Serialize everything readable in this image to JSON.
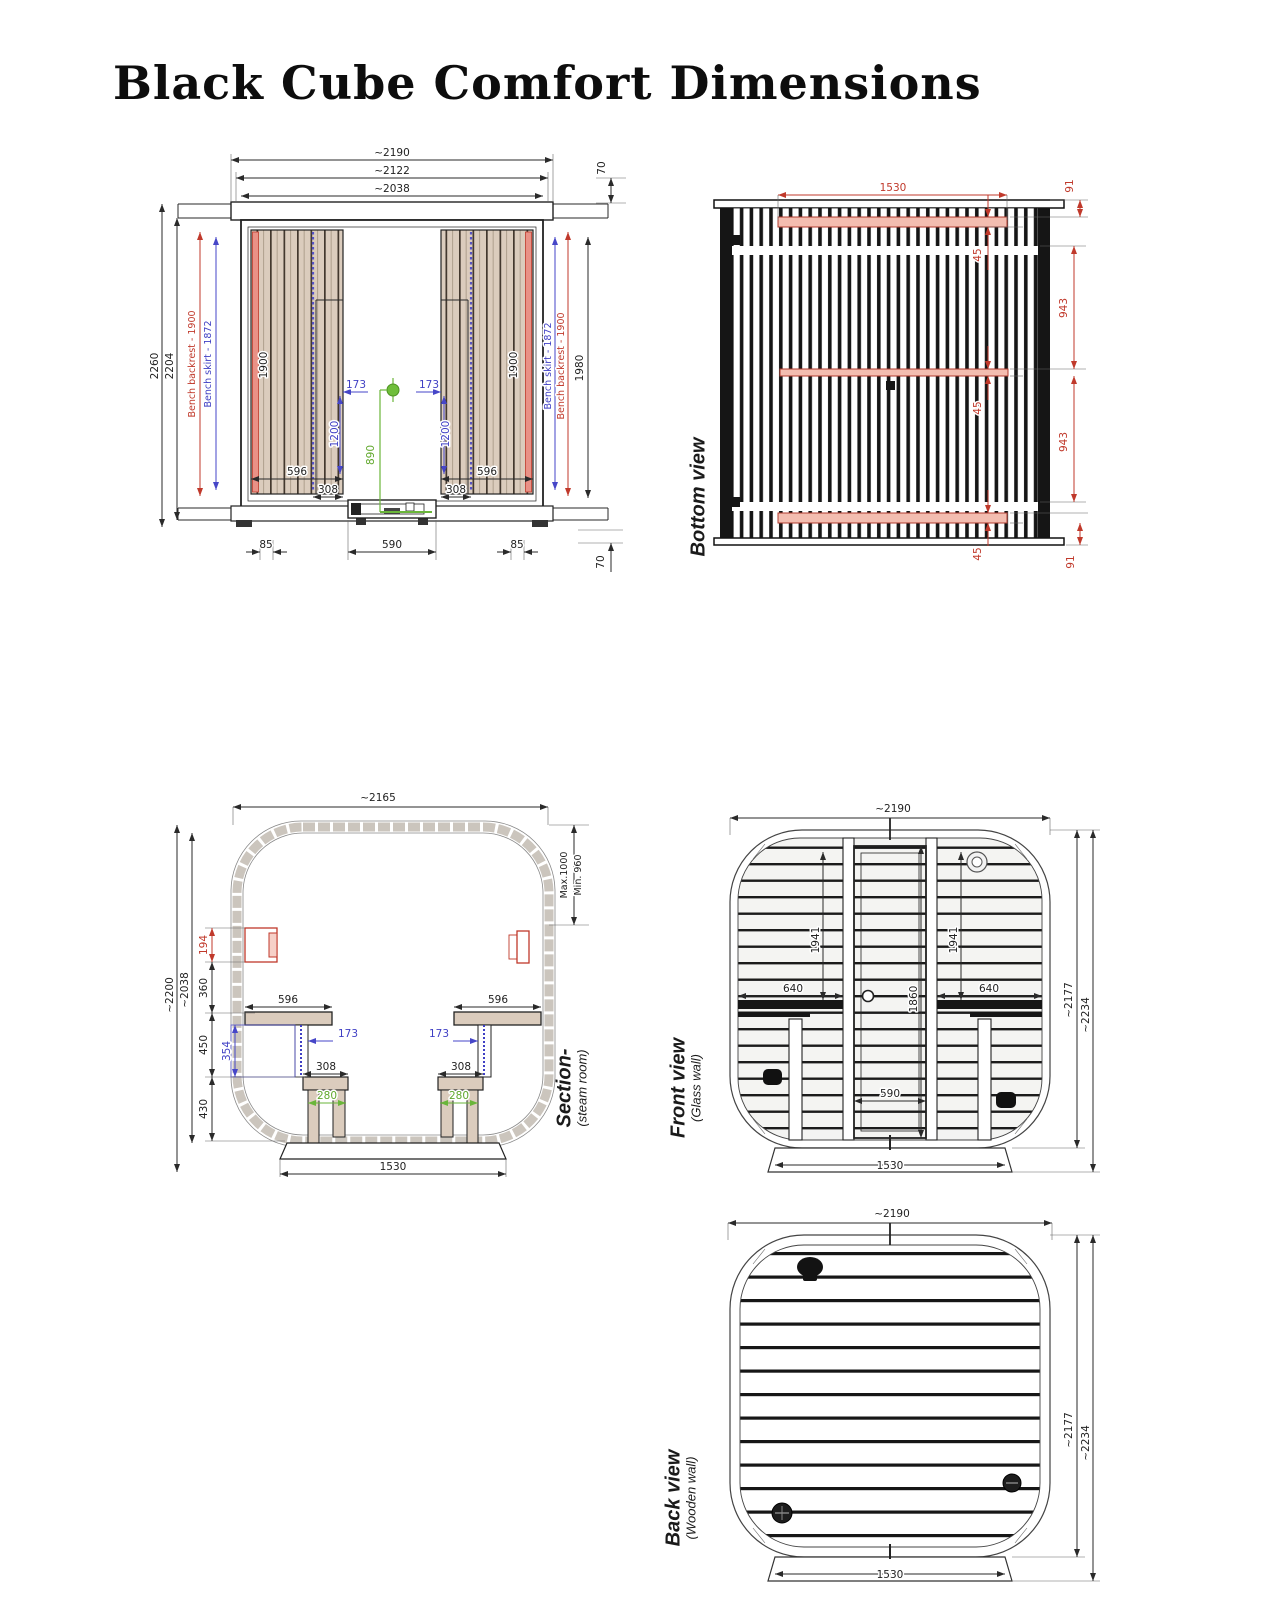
{
  "title": "Black Cube Comfort Dimensions",
  "colors": {
    "dim_black": "#2a2a2a",
    "dim_red": "#c0392b",
    "dim_blue": "#3f3fc4",
    "dim_green": "#61a82d",
    "wood_tan": "#dbccbd",
    "pink_runner": "#f3bdb0",
    "shell_gray": "#cbc5bd"
  },
  "top_view": {
    "d2190": "~2190",
    "d2122": "~2122",
    "d2038": "~2038",
    "d70_top": "70",
    "d70_bottom": "70",
    "d2260": "2260",
    "d2204": "2204",
    "backrest_left": "Bench backrest - 1900",
    "skirt_left": "Bench skirt - 1872",
    "skirt_right": "Bench skirt - 1872",
    "backrest_right": "Bench backrest - 1900",
    "d1900_left": "1900",
    "d1900_right": "1900",
    "d1980": "1980",
    "d173_left": "173",
    "d173_right": "173",
    "d1200_left": "1200",
    "d1200_right": "1200",
    "d596_left": "596",
    "d596_right": "596",
    "d308_left": "308",
    "d308_right": "308",
    "d890": "890",
    "d85_left": "85",
    "d590": "590",
    "d85_right": "85"
  },
  "bottom_view": {
    "label": "Bottom view",
    "d1530": "1530",
    "d91_top": "91",
    "d91_bottom": "91",
    "d45_top": "45",
    "d45_mid": "45",
    "d45_bottom": "45",
    "d943_top": "943",
    "d943_bottom": "943"
  },
  "section": {
    "label": "Section-",
    "sublabel": "(steam room)",
    "d2165": "~2165",
    "max": "Max.1000",
    "min": "Min. 960",
    "d2200": "~2200",
    "d2038": "~2038",
    "d194": "194",
    "d360": "360",
    "d450": "450",
    "d430": "430",
    "d354": "354",
    "d596_left": "596",
    "d596_right": "596",
    "d173_left": "173",
    "d173_right": "173",
    "d308_left": "308",
    "d308_right": "308",
    "d280_left": "280",
    "d280_right": "280",
    "d1530": "1530"
  },
  "front_view": {
    "label": "Front view",
    "sublabel": "(Glass wall)",
    "d2190": "~2190",
    "d1941_left": "1941",
    "d1941_right": "1941",
    "d640_left": "640",
    "d640_right": "640",
    "d1860": "1860",
    "d590": "590",
    "d1530": "1530",
    "d2177": "~2177",
    "d2234": "~2234"
  },
  "back_view": {
    "label": "Back view",
    "sublabel": "(Wooden wall)",
    "d2190": "~2190",
    "d2177": "~2177",
    "d2234": "~2234",
    "d1530": "1530"
  }
}
